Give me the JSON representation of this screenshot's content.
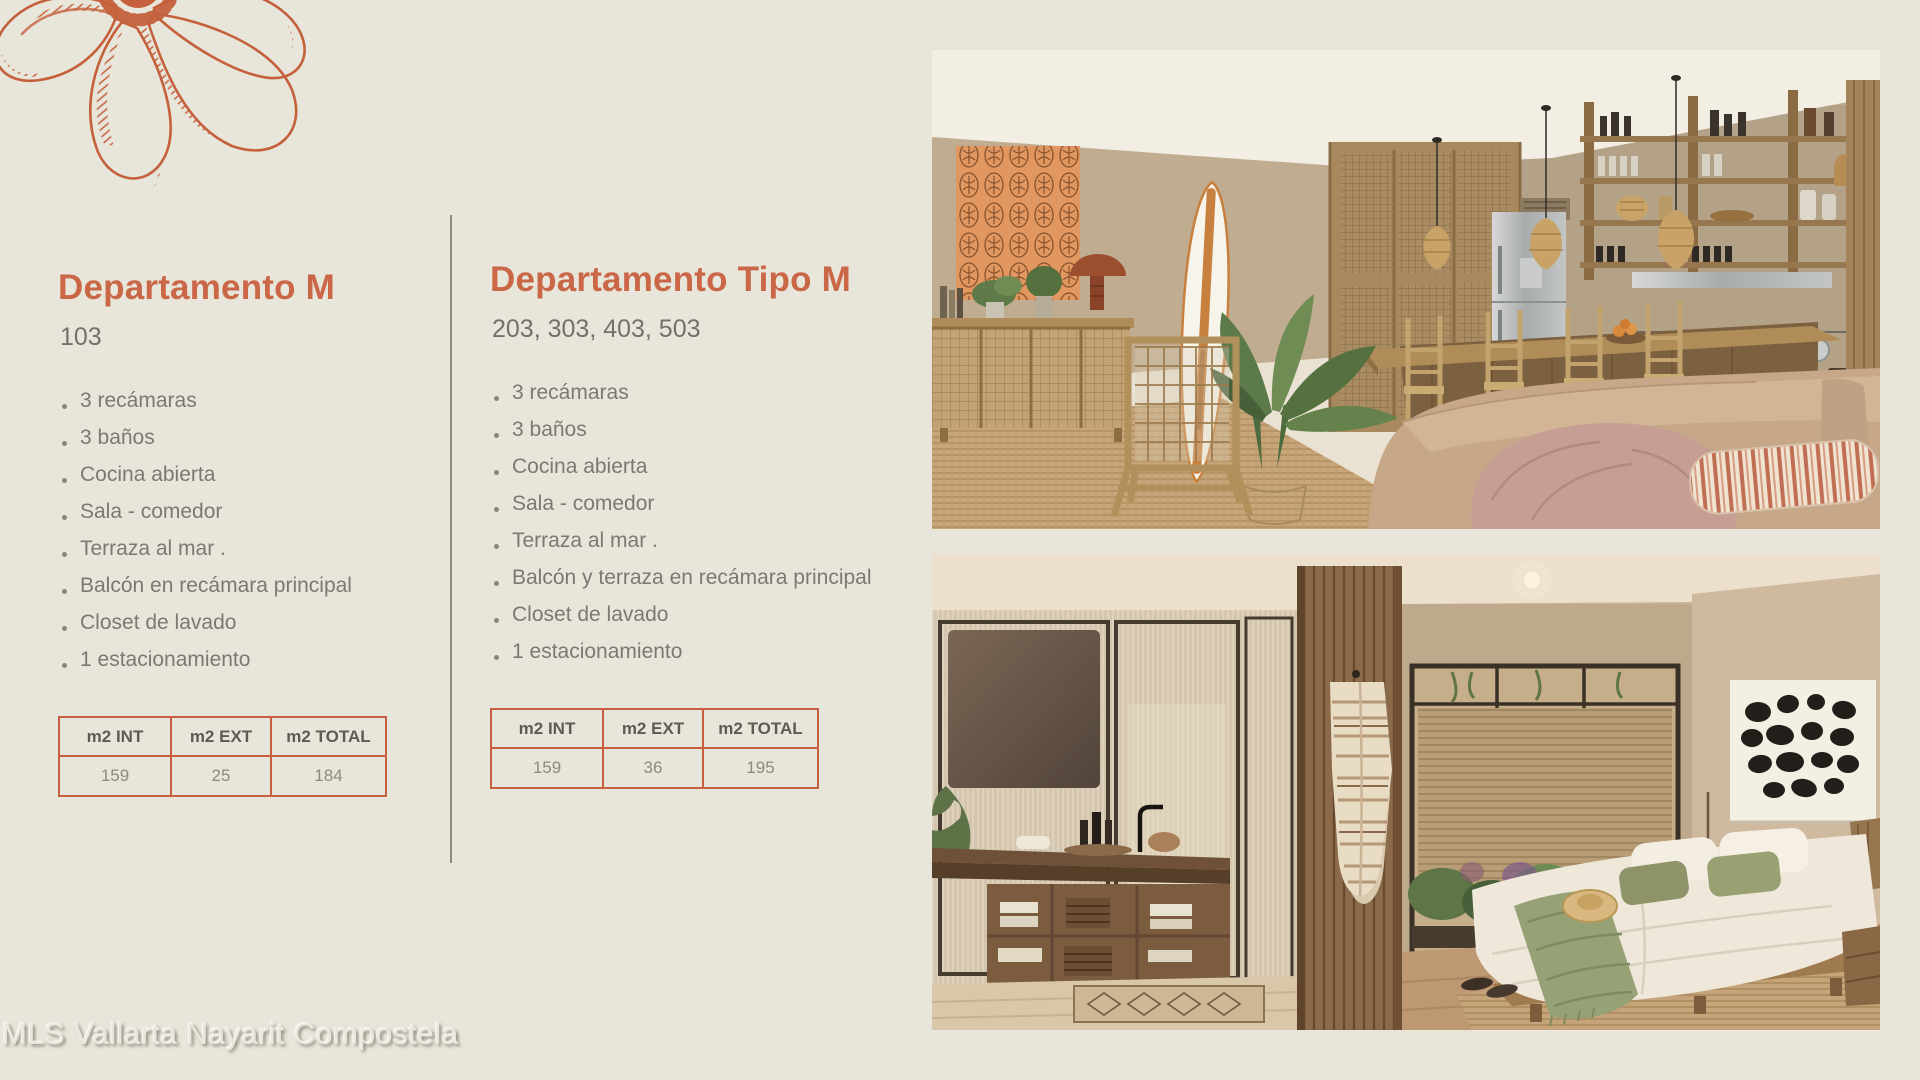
{
  "page": {
    "background": "#e8e5da",
    "accent": "#c96747",
    "watermark": "MLS Vallarta Nayarit Compostela"
  },
  "logo": {
    "name": "orange-engraved-flower-logo",
    "color": "#c4613c"
  },
  "unit_left": {
    "title": "Departamento M",
    "units": "103",
    "features": [
      "3 recámaras",
      "3 baños",
      "Cocina abierta",
      "Sala - comedor",
      "Terraza al mar .",
      "Balcón en recámara principal",
      "Closet de lavado",
      "1 estacionamiento"
    ],
    "table": {
      "headers": [
        "m2 INT",
        "m2 EXT",
        "m2 TOTAL"
      ],
      "values": [
        "159",
        "25",
        "184"
      ]
    }
  },
  "unit_right": {
    "title": "Departamento Tipo M",
    "units": "203, 303, 403, 503",
    "features": [
      "3 recámaras",
      "3 baños",
      "Cocina abierta",
      "Sala - comedor",
      "Terraza al mar .",
      "Balcón y terraza en recámara principal",
      "Closet de lavado",
      "1 estacionamiento"
    ],
    "table": {
      "headers": [
        "m2 INT",
        "m2 EXT",
        "m2 TOTAL"
      ],
      "values": [
        "159",
        "36",
        "195"
      ]
    }
  },
  "photos": {
    "top": {
      "name": "living-room-open-kitchen-render"
    },
    "bottom": {
      "name": "bathroom-bedroom-render"
    }
  }
}
